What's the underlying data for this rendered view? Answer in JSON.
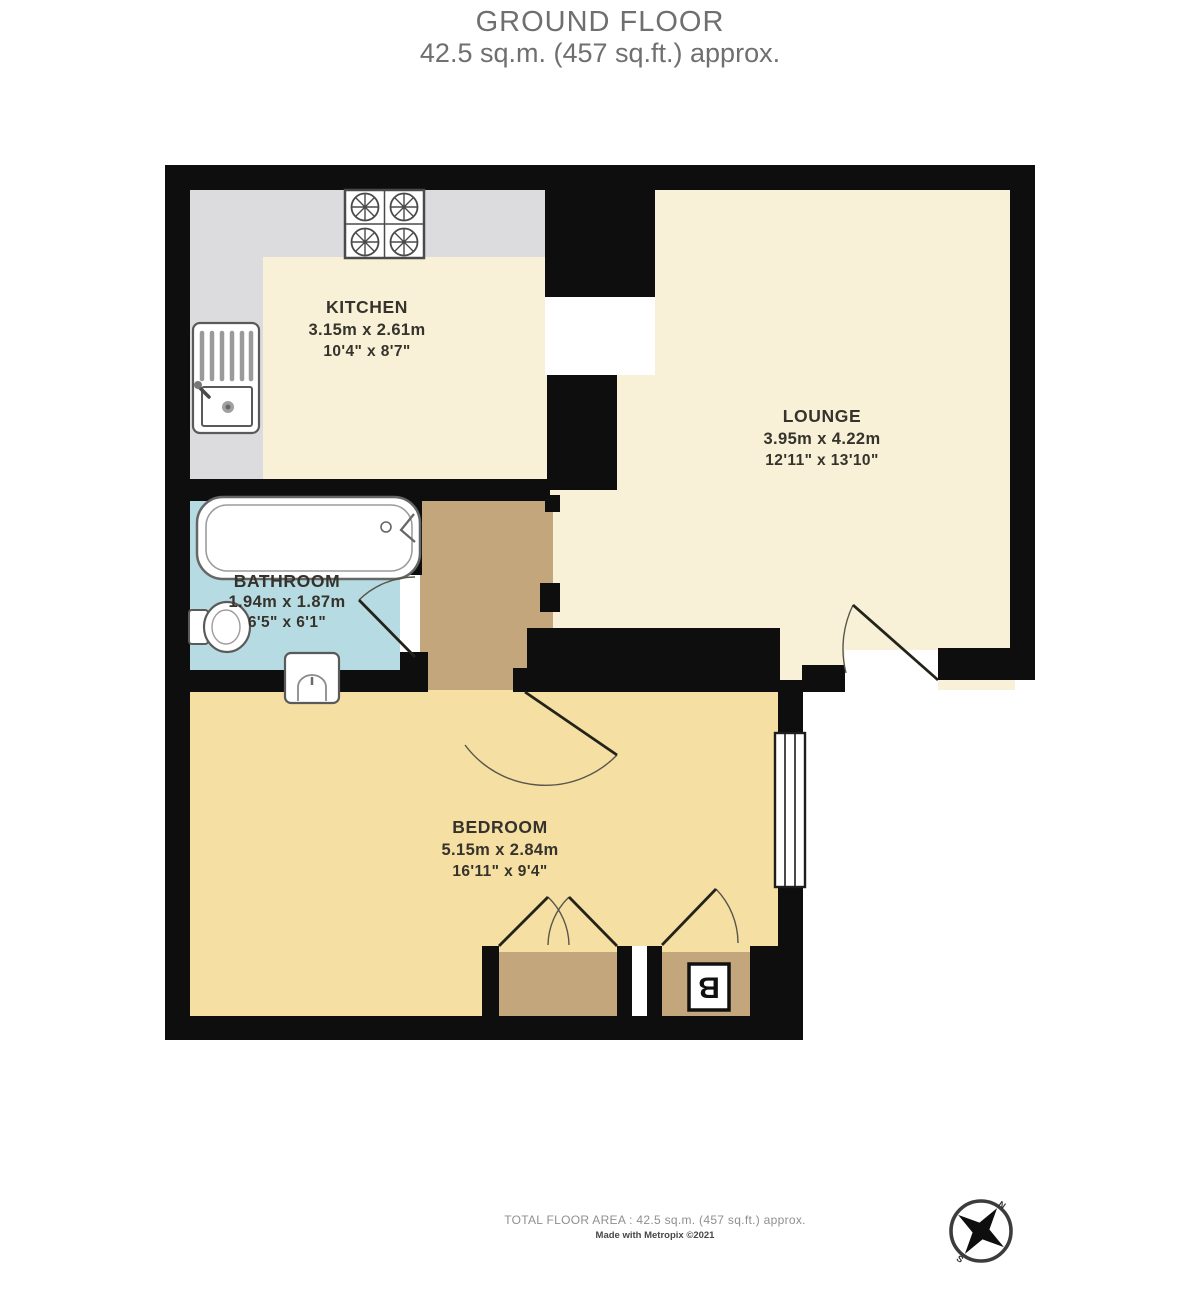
{
  "header": {
    "floor_name": "GROUND FLOOR",
    "floor_area": "42.5 sq.m. (457 sq.ft.) approx."
  },
  "rooms": [
    {
      "name": "KITCHEN",
      "metric": "3.15m x 2.61m",
      "imperial": "10'4\" x 8'7\""
    },
    {
      "name": "LOUNGE",
      "metric": "3.95m x 4.22m",
      "imperial": "12'11\" x 13'10\""
    },
    {
      "name": "BATHROOM",
      "metric": "1.94m x 1.87m",
      "imperial": "6'5\" x 6'1\""
    },
    {
      "name": "BEDROOM",
      "metric": "5.15m x 2.84m",
      "imperial": "16'11\" x 9'4\""
    }
  ],
  "labels": {
    "boiler": "B"
  },
  "footer": {
    "total_area": "TOTAL FLOOR AREA : 42.5 sq.m. (457 sq.ft.) approx.",
    "credit": "Made with Metropix ©2021"
  },
  "colors": {
    "wall": "#0e0e0e",
    "cream_floor": "#f8f1d7",
    "bedroom_floor": "#f6dfa3",
    "hall_floor": "#c4a67c",
    "bathroom_floor": "#b7dbe2",
    "counter_gray": "#dcdcde",
    "label_text": "#35332b",
    "fixture_stroke": "#555555"
  }
}
